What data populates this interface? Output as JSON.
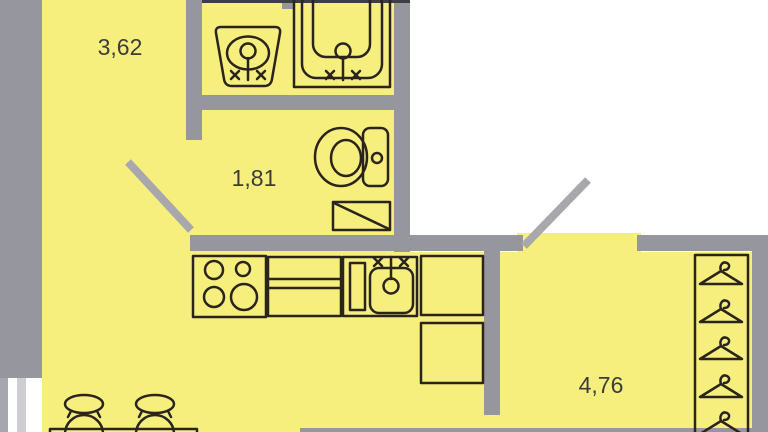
{
  "plan_type": "apartment-floor-plan",
  "rooms": [
    {
      "id": "room-top-left",
      "area_label": "3,62"
    },
    {
      "id": "room-wc",
      "area_label": "1,81"
    },
    {
      "id": "room-hall",
      "area_label": "4,76"
    }
  ],
  "fixtures": [
    "washbasin-icon",
    "bathtub-icon",
    "toilet-icon",
    "washing-machine-icon",
    "stove-icon",
    "kitchen-counter",
    "kitchen-sink-icon",
    "base-cabinet",
    "base-cabinet",
    "wardrobe",
    "clothes-hanger-icon",
    "stool-icon",
    "stool-icon",
    "dining-table"
  ],
  "openings": [
    "window",
    "interior-door-swing",
    "entrance-door-swing"
  ],
  "colors": {
    "background": "#FFFFFF",
    "floor": "#F6EF7E",
    "wall": "#96969E",
    "door": "#A8A8AC",
    "outline": "#2A241C",
    "label": "#3C3C3C",
    "window_line": "#A6A6AE",
    "window_line_light": "#CDCDD2",
    "top_edge": "#3D3D44"
  }
}
